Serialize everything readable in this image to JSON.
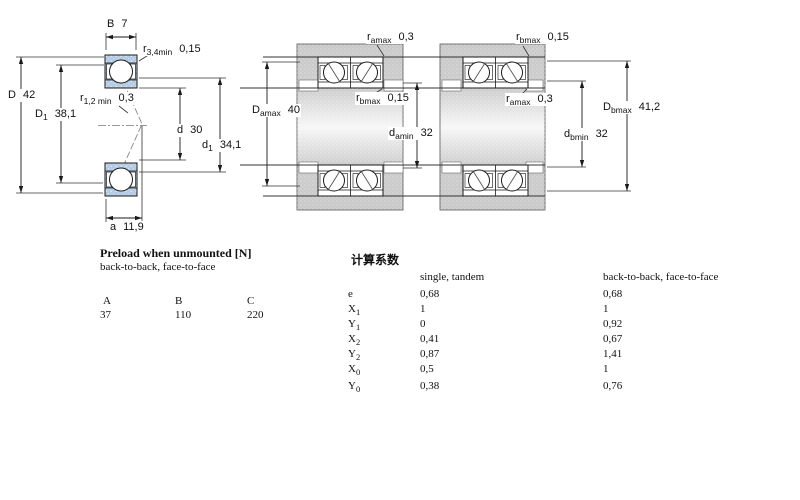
{
  "diagram_unmounted": {
    "labels": {
      "B": {
        "sym": "B",
        "sub": "",
        "value": "7"
      },
      "r34": {
        "sym": "r",
        "sub": "3,4min",
        "value": "0,15"
      },
      "D": {
        "sym": "D",
        "sub": "",
        "value": "42"
      },
      "D1": {
        "sym": "D",
        "sub": "1",
        "value": "38,1"
      },
      "r12": {
        "sym": "r",
        "sub": "1,2 min",
        "value": "0,3"
      },
      "d": {
        "sym": "d",
        "sub": "",
        "value": "30"
      },
      "d1": {
        "sym": "d",
        "sub": "1",
        "value": "34,1"
      },
      "a": {
        "sym": "a",
        "sub": "",
        "value": "11,9"
      }
    }
  },
  "diagram_mounted_a": {
    "labels": {
      "ra_top": {
        "sym": "r",
        "sub": "amax",
        "value": "0,3"
      },
      "rb_mid": {
        "sym": "r",
        "sub": "bmax",
        "value": "0,15"
      },
      "Da": {
        "sym": "D",
        "sub": "amax",
        "value": "40"
      },
      "da": {
        "sym": "d",
        "sub": "amin",
        "value": "32"
      }
    }
  },
  "diagram_mounted_b": {
    "labels": {
      "rb_top": {
        "sym": "r",
        "sub": "bmax",
        "value": "0,15"
      },
      "ra_mid": {
        "sym": "r",
        "sub": "amax",
        "value": "0,3"
      },
      "Db": {
        "sym": "D",
        "sub": "bmax",
        "value": "41,2"
      },
      "db": {
        "sym": "d",
        "sub": "bmin",
        "value": "32"
      }
    }
  },
  "preload_table": {
    "title": "Preload when unmounted [N]",
    "subtitle": "back-to-back, face-to-face",
    "columns": [
      "A",
      "B",
      "C"
    ],
    "values": [
      "37",
      "110",
      "220"
    ]
  },
  "factors_table": {
    "title": "计算系数",
    "col1_header": "single, tandem",
    "col2_header": "back-to-back, face-to-face",
    "rows": [
      {
        "sym": "e",
        "sub": "",
        "v1": "0,68",
        "v2": "0,68"
      },
      {
        "sym": "X",
        "sub": "1",
        "v1": "1",
        "v2": "1"
      },
      {
        "sym": "Y",
        "sub": "1",
        "v1": "0",
        "v2": "0,92"
      },
      {
        "sym": "X",
        "sub": "2",
        "v1": "0,41",
        "v2": "0,67"
      },
      {
        "sym": "Y",
        "sub": "2",
        "v1": "0,87",
        "v2": "1,41"
      },
      {
        "sym": "X",
        "sub": "0",
        "v1": "0,5",
        "v2": "1"
      },
      {
        "sym": "Y",
        "sub": "0",
        "v1": "0,38",
        "v2": "0,76"
      }
    ]
  },
  "colors": {
    "ring_blue": "#b5cce4",
    "housing_gray": "#cbcbcb",
    "line": "#1a1a1a"
  }
}
